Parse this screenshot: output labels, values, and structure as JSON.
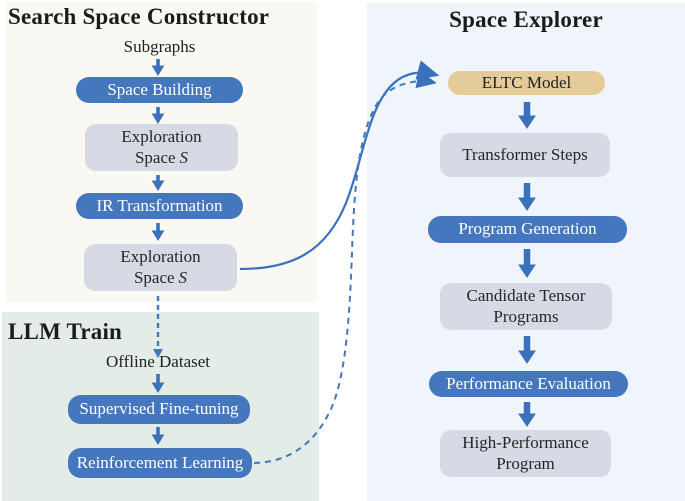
{
  "figure": {
    "type": "flowchart",
    "description": "Three-panel pipeline diagram: Search Space Constructor feeds LLM Train and Space Explorer"
  },
  "colors": {
    "process_box": "#4577be",
    "data_box": "#d7dae5",
    "model_box": "#e5cb97",
    "constructor_panel_bg": "#faf8f2",
    "llm_panel_bg": "#e3ece7",
    "explorer_panel_bg": "#eff5fa",
    "arrow": "#3b70bc",
    "title_text": "#1b1b1b"
  },
  "constructor": {
    "title": "Search Space Constructor",
    "input_label": "Subgraphs",
    "space_building": "Space Building",
    "exploration_space": {
      "line1": "Exploration",
      "line2": "Space",
      "variable": "S"
    },
    "ir_transformation": "IR Transformation"
  },
  "llm_train": {
    "title": "LLM Train",
    "input_label": "Offline Dataset",
    "supervised": "Supervised Fine-tuning",
    "reinforcement": "Reinforcement Learning"
  },
  "explorer": {
    "title": "Space Explorer",
    "eltc_model": "ELTC Model",
    "transformer_steps": "Transformer Steps",
    "program_generation": "Program Generation",
    "candidate_programs": {
      "line1": "Candidate Tensor",
      "line2": "Programs"
    },
    "performance_evaluation": "Performance Evaluation",
    "high_performance": {
      "line1": "High-Performance",
      "line2": "Program"
    }
  }
}
